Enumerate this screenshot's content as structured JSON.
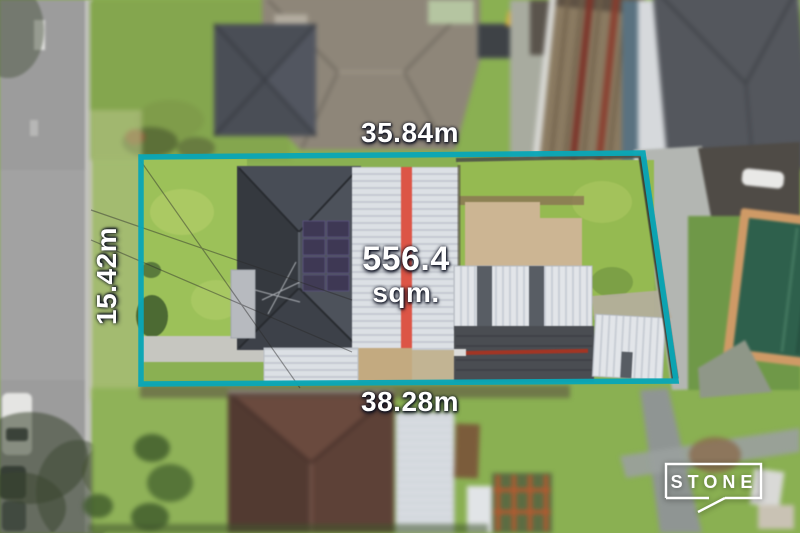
{
  "measurements": {
    "top": "35.84m",
    "left": "15.42m",
    "bottom": "38.28m",
    "area_value": "556.4",
    "area_unit": "sqm."
  },
  "logo": {
    "text": "STONE"
  },
  "colors": {
    "boundary": "#0aa6b6",
    "label": "#ffffff",
    "grass": "#8ab052",
    "road": "#9c9c9c",
    "roof_dark": "#42464e",
    "roof_white": "#dce0e5",
    "stripe_red": "#dc5546",
    "pool_water": "#2e604c",
    "pool_coping": "#cf9a66"
  }
}
